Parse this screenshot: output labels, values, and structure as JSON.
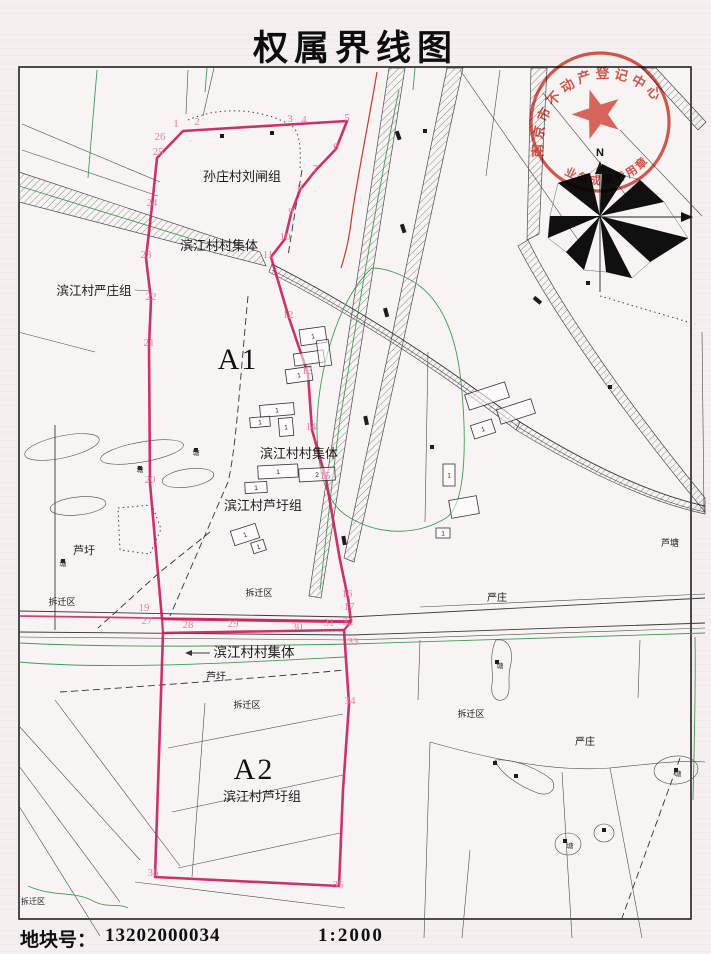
{
  "page": {
    "title": "权属界线图",
    "footer": {
      "parcel_no_label": "地块号：",
      "parcel_no": "13202000034",
      "scale": "1:2000"
    }
  },
  "stamp": {
    "arc_text": "南京市不动产登记中心",
    "bottom_text": "业务成果专用章",
    "color": "#d23b2e"
  },
  "compass": {
    "north_label": "N"
  },
  "map": {
    "colors": {
      "boundary_red": "#c81f5a",
      "point_pink": "#e77fa8",
      "line_green": "#3d9c55",
      "ink": "#4a4a4a"
    },
    "labels": [
      {
        "name": "label-sunzhuang-liuzha-group",
        "text": "孙庄村刘闸组",
        "x": 242,
        "y": 181,
        "s": 13
      },
      {
        "name": "label-binjiang-collective-1",
        "text": "滨江村村集体",
        "x": 219,
        "y": 250,
        "s": 13
      },
      {
        "name": "label-binjiang-yanzhuang-group",
        "text": "滨江村严庄组",
        "x": 94,
        "y": 295,
        "s": 12.5
      },
      {
        "name": "label-binjiang-collective-2",
        "text": "滨江村村集体",
        "x": 299,
        "y": 458,
        "s": 13
      },
      {
        "name": "label-binjiang-luxu-group-1",
        "text": "滨江村芦圩组",
        "x": 263,
        "y": 510,
        "s": 13
      },
      {
        "name": "label-luxu-1",
        "text": "芦圩",
        "x": 84,
        "y": 554,
        "s": 11
      },
      {
        "name": "label-demolition-zone-1",
        "text": "拆迁区",
        "x": 62,
        "y": 605,
        "s": 9
      },
      {
        "name": "label-demolition-zone-2",
        "text": "拆迁区",
        "x": 259,
        "y": 596,
        "s": 9
      },
      {
        "name": "label-yanzhuang-1",
        "text": "严庄",
        "x": 497,
        "y": 601,
        "s": 10
      },
      {
        "name": "label-lutang",
        "text": "芦塘",
        "x": 670,
        "y": 546,
        "s": 9
      },
      {
        "name": "label-binjiang-collective-3",
        "text": "滨江村村集体",
        "x": 254,
        "y": 657,
        "s": 13.5
      },
      {
        "name": "label-luxu-2",
        "text": "芦圩",
        "x": 216,
        "y": 680,
        "s": 10
      },
      {
        "name": "label-demolition-zone-3",
        "text": "拆迁区",
        "x": 247,
        "y": 708,
        "s": 9
      },
      {
        "name": "label-demolition-zone-4",
        "text": "拆迁区",
        "x": 471,
        "y": 717,
        "s": 9
      },
      {
        "name": "label-binjiang-luxu-group-2",
        "text": "滨江村芦圩组",
        "x": 262,
        "y": 801,
        "s": 13
      },
      {
        "name": "label-yanzhuang-2",
        "text": "严庄",
        "x": 585,
        "y": 745,
        "s": 10
      },
      {
        "name": "label-demolition-zone-5",
        "text": "拆迁区",
        "x": 33,
        "y": 904,
        "s": 8
      },
      {
        "name": "parcel-a1-label",
        "text": "A1",
        "x": 238,
        "y": 369,
        "s": 30,
        "cls": "parcel"
      },
      {
        "name": "parcel-a2-label",
        "text": "A2",
        "x": 254,
        "y": 779,
        "s": 30,
        "cls": "parcel"
      },
      {
        "name": "pond-label-1",
        "text": "塘",
        "x": 196,
        "y": 455,
        "s": 7,
        "cls": "tiny"
      },
      {
        "name": "pond-label-2",
        "text": "塘",
        "x": 140,
        "y": 472,
        "s": 7,
        "cls": "tiny"
      },
      {
        "name": "pond-label-3",
        "text": "塘",
        "x": 63,
        "y": 566,
        "s": 7,
        "cls": "tiny"
      },
      {
        "name": "pond-label-4",
        "text": "塘",
        "x": 500,
        "y": 668,
        "s": 7,
        "cls": "tiny"
      },
      {
        "name": "pond-label-5",
        "text": "塘",
        "x": 678,
        "y": 776,
        "s": 7,
        "cls": "tiny"
      },
      {
        "name": "pond-label-6",
        "text": "塘",
        "x": 570,
        "y": 848,
        "s": 7,
        "cls": "tiny"
      }
    ],
    "boundary_points": [
      {
        "n": "1",
        "x": 176,
        "y": 127
      },
      {
        "n": "2",
        "x": 197,
        "y": 125
      },
      {
        "n": "3",
        "x": 290,
        "y": 122
      },
      {
        "n": "4",
        "x": 304,
        "y": 123
      },
      {
        "n": "5",
        "x": 347,
        "y": 121
      },
      {
        "n": "6",
        "x": 336,
        "y": 150
      },
      {
        "n": "7",
        "x": 315,
        "y": 172
      },
      {
        "n": "8",
        "x": 300,
        "y": 191
      },
      {
        "n": "9",
        "x": 291,
        "y": 215
      },
      {
        "n": "10",
        "x": 285,
        "y": 240
      },
      {
        "n": "11",
        "x": 268,
        "y": 258
      },
      {
        "n": "12",
        "x": 288,
        "y": 318
      },
      {
        "n": "13",
        "x": 307,
        "y": 374
      },
      {
        "n": "14",
        "x": 311,
        "y": 430
      },
      {
        "n": "15",
        "x": 325,
        "y": 479
      },
      {
        "n": "16",
        "x": 347,
        "y": 597
      },
      {
        "n": "17",
        "x": 349,
        "y": 610
      },
      {
        "n": "19",
        "x": 144,
        "y": 611
      },
      {
        "n": "20",
        "x": 150,
        "y": 483
      },
      {
        "n": "21",
        "x": 149,
        "y": 346
      },
      {
        "n": "22",
        "x": 151,
        "y": 300
      },
      {
        "n": "23",
        "x": 146,
        "y": 258
      },
      {
        "n": "24",
        "x": 152,
        "y": 206
      },
      {
        "n": "25",
        "x": 158,
        "y": 155
      },
      {
        "n": "26",
        "x": 160,
        "y": 140
      },
      {
        "n": "27",
        "x": 147,
        "y": 624
      },
      {
        "n": "28",
        "x": 188,
        "y": 628
      },
      {
        "n": "29",
        "x": 233,
        "y": 627
      },
      {
        "n": "30",
        "x": 297,
        "y": 630
      },
      {
        "n": "31",
        "x": 329,
        "y": 626
      },
      {
        "n": "32",
        "x": 348,
        "y": 625
      },
      {
        "n": "33",
        "x": 353,
        "y": 645
      },
      {
        "n": "34",
        "x": 350,
        "y": 704
      },
      {
        "n": "35",
        "x": 338,
        "y": 888
      },
      {
        "n": "36",
        "x": 153,
        "y": 876
      }
    ],
    "buildings": [
      {
        "x": 300,
        "y": 328,
        "w": 26,
        "h": 16,
        "r": -8,
        "t": "1"
      },
      {
        "x": 294,
        "y": 352,
        "w": 30,
        "h": 12,
        "r": -8,
        "t": ""
      },
      {
        "x": 286,
        "y": 368,
        "w": 26,
        "h": 14,
        "r": -8,
        "t": "1"
      },
      {
        "x": 318,
        "y": 340,
        "w": 12,
        "h": 26,
        "r": -8,
        "t": ""
      },
      {
        "x": 260,
        "y": 404,
        "w": 34,
        "h": 12,
        "r": -5,
        "t": "1"
      },
      {
        "x": 250,
        "y": 417,
        "w": 20,
        "h": 10,
        "r": -5,
        "t": "1"
      },
      {
        "x": 279,
        "y": 418,
        "w": 14,
        "h": 18,
        "r": -5,
        "t": "1"
      },
      {
        "x": 258,
        "y": 465,
        "w": 40,
        "h": 13,
        "r": -3,
        "t": "1"
      },
      {
        "x": 299,
        "y": 468,
        "w": 36,
        "h": 13,
        "r": -3,
        "t": "2"
      },
      {
        "x": 245,
        "y": 482,
        "w": 22,
        "h": 11,
        "r": -3,
        "t": "1"
      },
      {
        "x": 232,
        "y": 527,
        "w": 26,
        "h": 15,
        "r": -18,
        "t": "1"
      },
      {
        "x": 252,
        "y": 541,
        "w": 13,
        "h": 11,
        "r": -18,
        "t": "1"
      },
      {
        "x": 466,
        "y": 388,
        "w": 42,
        "h": 16,
        "r": -18,
        "t": ""
      },
      {
        "x": 498,
        "y": 404,
        "w": 36,
        "h": 15,
        "r": -18,
        "t": ""
      },
      {
        "x": 472,
        "y": 422,
        "w": 22,
        "h": 14,
        "r": -18,
        "t": "1"
      },
      {
        "x": 443,
        "y": 464,
        "w": 12,
        "h": 22,
        "r": 0,
        "t": "1"
      },
      {
        "x": 450,
        "y": 498,
        "w": 28,
        "h": 18,
        "r": -10,
        "t": ""
      },
      {
        "x": 436,
        "y": 528,
        "w": 14,
        "h": 10,
        "r": 0,
        "t": "1"
      }
    ],
    "markers": [
      [
        222,
        136
      ],
      [
        272,
        133
      ],
      [
        425,
        131
      ],
      [
        588,
        283
      ],
      [
        610,
        387
      ],
      [
        432,
        447
      ],
      [
        196,
        450
      ],
      [
        140,
        468
      ],
      [
        63,
        561
      ],
      [
        497,
        662
      ],
      [
        495,
        763
      ],
      [
        516,
        776
      ],
      [
        676,
        770
      ],
      [
        565,
        841
      ],
      [
        604,
        830
      ]
    ]
  }
}
